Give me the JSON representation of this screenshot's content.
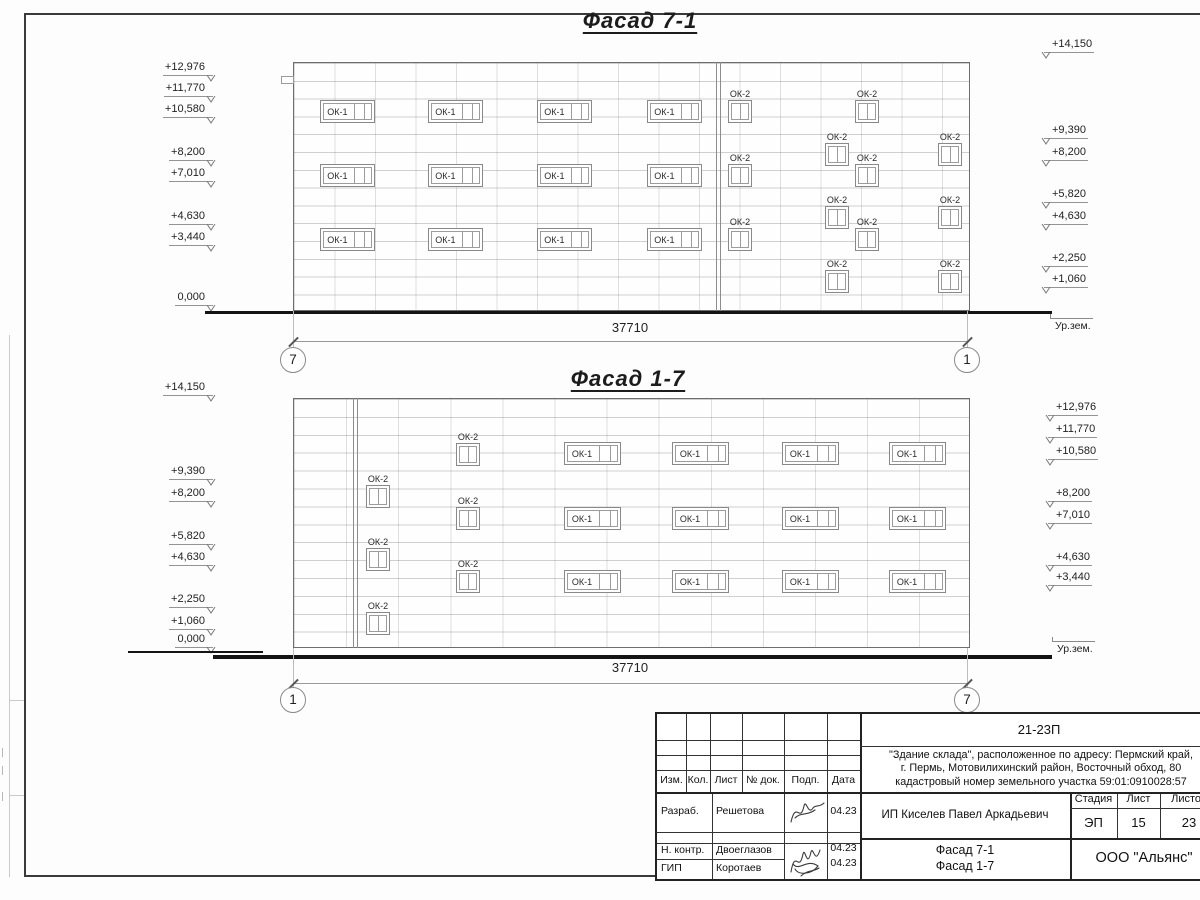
{
  "drawing": {
    "facades": [
      {
        "title": "Фасад 7-1",
        "title_pos": {
          "cx": 640,
          "y": 8
        },
        "building": {
          "x": 293,
          "y": 62,
          "w": 677,
          "h": 249,
          "hpitch": 17.8,
          "vpitch": 40.5,
          "joints": [
            718
          ]
        },
        "tab": {
          "x": 281,
          "y": 76,
          "w": 13,
          "h": 8
        },
        "window_groups": [
          {
            "type": "ОК-1",
            "w": 55,
            "h": 23,
            "label_inside": true,
            "positions": [
              [
                320,
                100
              ],
              [
                428,
                100
              ],
              [
                537,
                100
              ],
              [
                647,
                100
              ],
              [
                320,
                164
              ],
              [
                428,
                164
              ],
              [
                537,
                164
              ],
              [
                647,
                164
              ],
              [
                320,
                228
              ],
              [
                428,
                228
              ],
              [
                537,
                228
              ],
              [
                647,
                228
              ]
            ]
          },
          {
            "type": "ОК-2",
            "w": 24,
            "h": 23,
            "label_inside": false,
            "positions": [
              [
                728,
                100
              ],
              [
                855,
                100
              ],
              [
                728,
                164
              ],
              [
                855,
                164
              ],
              [
                728,
                228
              ],
              [
                855,
                228
              ],
              [
                825,
                143
              ],
              [
                938,
                143
              ],
              [
                825,
                206
              ],
              [
                938,
                206
              ],
              [
                825,
                270
              ],
              [
                938,
                270
              ]
            ]
          }
        ],
        "marks_left": {
          "anchor_x": 213,
          "items": [
            {
              "label": "+12,976",
              "y": 68
            },
            {
              "label": "+11,770",
              "y": 89
            },
            {
              "label": "+10,580",
              "y": 110
            },
            {
              "label": "+8,200",
              "y": 153
            },
            {
              "label": "+7,010",
              "y": 174
            },
            {
              "label": "+4,630",
              "y": 217
            },
            {
              "label": "+3,440",
              "y": 238
            },
            {
              "label": "0,000",
              "y": 298
            }
          ]
        },
        "marks_right": {
          "anchor_x": 1044,
          "items": [
            {
              "label": "+14,150",
              "y": 45
            },
            {
              "label": "+9,390",
              "y": 131
            },
            {
              "label": "+8,200",
              "y": 153
            },
            {
              "label": "+5,820",
              "y": 195
            },
            {
              "label": "+4,630",
              "y": 217
            },
            {
              "label": "+2,250",
              "y": 259
            },
            {
              "label": "+1,060",
              "y": 280
            }
          ]
        },
        "ground_segments": [
          {
            "x1": 205,
            "x2": 1052,
            "y": 311,
            "th": 3
          }
        ],
        "ground_label": {
          "text": "Ур.зем.",
          "x": 1051,
          "y": 318
        },
        "dimension": {
          "text": "37710",
          "x1": 293,
          "x2": 967,
          "line_y": 341,
          "text_y": 320,
          "bubble_y": 360,
          "axis_left": "7",
          "axis_right": "1"
        }
      },
      {
        "title": "Фасад 1-7",
        "title_pos": {
          "cx": 628,
          "y": 366
        },
        "building": {
          "x": 293,
          "y": 398,
          "w": 677,
          "h": 250,
          "hpitch": 17.9,
          "vpitch": 52.1,
          "joints": [
            355
          ]
        },
        "tab": null,
        "window_groups": [
          {
            "type": "ОК-1",
            "w": 57,
            "h": 23,
            "label_inside": true,
            "positions": [
              [
                564,
                442
              ],
              [
                672,
                442
              ],
              [
                782,
                442
              ],
              [
                889,
                442
              ],
              [
                564,
                507
              ],
              [
                672,
                507
              ],
              [
                782,
                507
              ],
              [
                889,
                507
              ],
              [
                564,
                570
              ],
              [
                672,
                570
              ],
              [
                782,
                570
              ],
              [
                889,
                570
              ]
            ]
          },
          {
            "type": "ОК-2",
            "w": 24,
            "h": 23,
            "label_inside": false,
            "positions": [
              [
                456,
                443
              ],
              [
                366,
                485
              ],
              [
                456,
                507
              ],
              [
                366,
                548
              ],
              [
                456,
                570
              ],
              [
                366,
                612
              ]
            ]
          }
        ],
        "marks_left": {
          "anchor_x": 213,
          "items": [
            {
              "label": "+14,150",
              "y": 388
            },
            {
              "label": "+9,390",
              "y": 472
            },
            {
              "label": "+8,200",
              "y": 494
            },
            {
              "label": "+5,820",
              "y": 537
            },
            {
              "label": "+4,630",
              "y": 558
            },
            {
              "label": "+2,250",
              "y": 600
            },
            {
              "label": "+1,060",
              "y": 622
            },
            {
              "label": "0,000",
              "y": 640
            }
          ]
        },
        "marks_right": {
          "anchor_x": 1048,
          "items": [
            {
              "label": "+12,976",
              "y": 408
            },
            {
              "label": "+11,770",
              "y": 430
            },
            {
              "label": "+10,580",
              "y": 452
            },
            {
              "label": "+8,200",
              "y": 494
            },
            {
              "label": "+7,010",
              "y": 516
            },
            {
              "label": "+4,630",
              "y": 558
            },
            {
              "label": "+3,440",
              "y": 578
            }
          ]
        },
        "ground_segments": [
          {
            "x1": 128,
            "x2": 263,
            "y": 651,
            "th": 2
          },
          {
            "x1": 213,
            "x2": 1052,
            "y": 655,
            "th": 4
          }
        ],
        "ground_label": {
          "text": "Ур.зем.",
          "x": 1053,
          "y": 641
        },
        "dimension": {
          "text": "37710",
          "x1": 293,
          "x2": 967,
          "line_y": 683,
          "text_y": 660,
          "bubble_y": 700,
          "axis_left": "1",
          "axis_right": "7"
        }
      }
    ]
  },
  "titleblock": {
    "doc_code": "21-23П",
    "object_lines": [
      "\"Здание склада\", расположенное по адресу: Пермский край,",
      "г. Пермь, Мотовилихинский район, Восточный обход, 80",
      "кадастровый номер земельного участка 59:01:0910028:57"
    ],
    "client": "ИП Киселев Павел Аркадьевич",
    "org": "ООО \"Альянс\"",
    "sheet_name_lines": [
      "Фасад 7-1",
      "Фасад 1-7"
    ],
    "rev_headers": [
      "Изм.",
      "Кол.",
      "Лист",
      "№ док.",
      "Подп.",
      "Дата"
    ],
    "stage_headers": [
      "Стадия",
      "Лист",
      "Листов"
    ],
    "stage": "ЭП",
    "sheet_no": "15",
    "sheets_total": "23",
    "signers": [
      {
        "role": "Разраб.",
        "name": "Решетова",
        "date": "04.23"
      },
      {
        "role": "Н. контр.",
        "name": "Двоеглазов",
        "date": "04.23"
      },
      {
        "role": "ГИП",
        "name": "Коротаев",
        "date": "04.23"
      }
    ]
  }
}
